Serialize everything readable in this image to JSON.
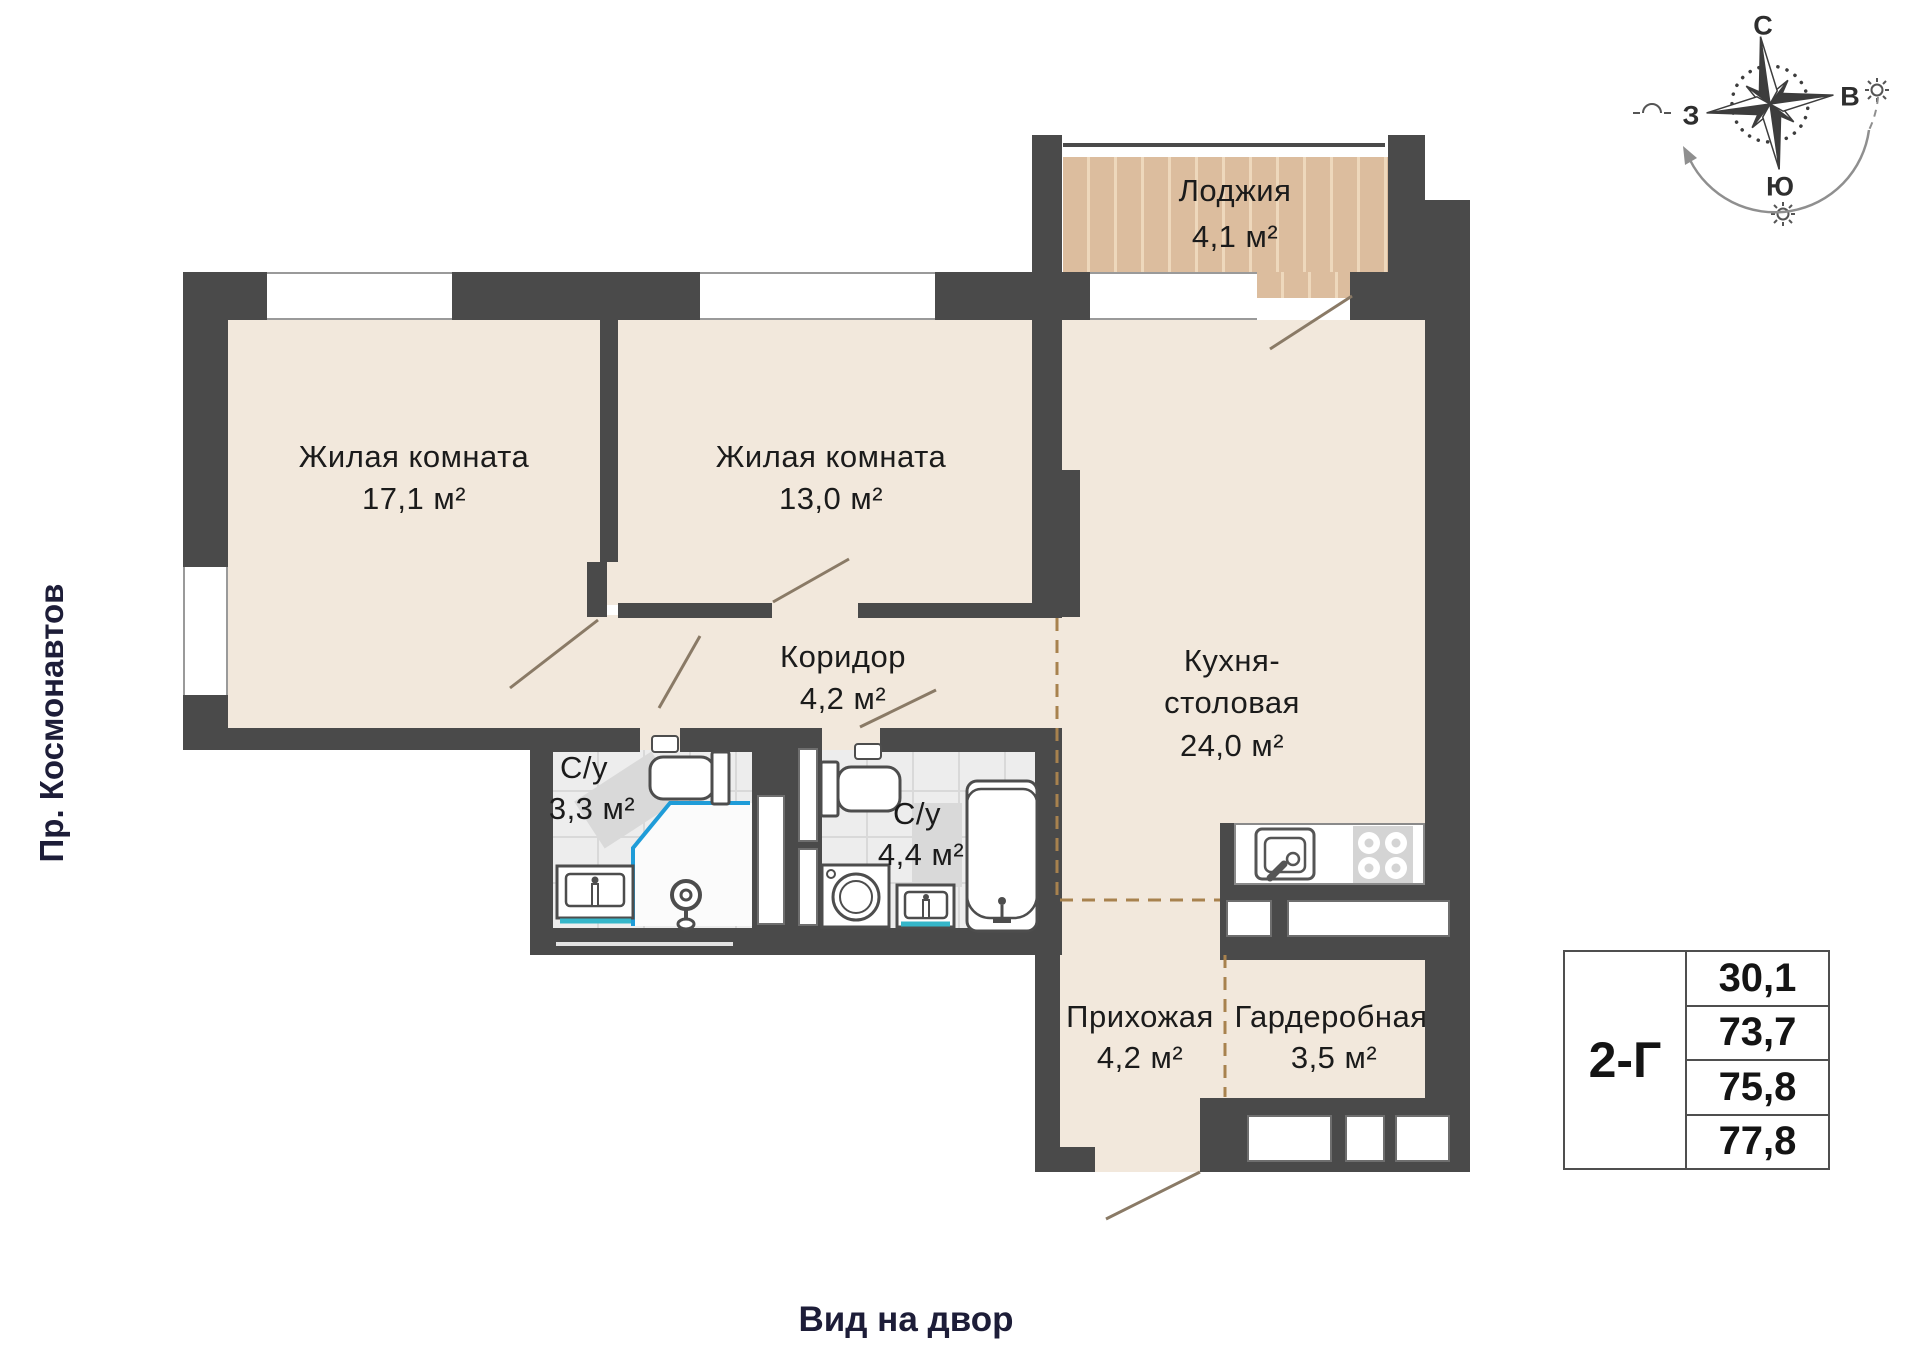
{
  "plan": {
    "street_label": "Пр. Космонавтов",
    "courtyard_label": "Вид на двор",
    "rooms": [
      {
        "name": "Жилая комната",
        "area": "17,1 м²"
      },
      {
        "name": "Жилая комната",
        "area": "13,0 м²"
      },
      {
        "name": "Коридор",
        "area": "4,2 м²"
      },
      {
        "name": "С/у",
        "area": "3,3 м²"
      },
      {
        "name": "С/у",
        "area": "4,4 м²"
      },
      {
        "name": "Кухня-",
        "name_line2": "столовая",
        "area": "24,0 м²"
      },
      {
        "name": "Лоджия",
        "area": "4,1 м²"
      },
      {
        "name": "Прихожая",
        "area": "4,2 м²"
      },
      {
        "name": "Гардеробная",
        "area": "3,5 м²"
      }
    ]
  },
  "compass": {
    "north": "С",
    "east": "В",
    "south": "Ю",
    "west": "З"
  },
  "info_table": {
    "unit": "2-Г",
    "values": [
      "30,1",
      "73,7",
      "75,8",
      "77,8"
    ]
  },
  "colors": {
    "wall": "#4a4a4a",
    "floor": "#f2e8dc",
    "loggia_floor": "#dcbd9e",
    "bathroom_floor": "#ededed",
    "shower_line_blue": "#1f9cd8",
    "sink_line_teal": "#35b6c9",
    "zone_dashed": "#a8824e",
    "outside_text": "#1d1d38"
  }
}
